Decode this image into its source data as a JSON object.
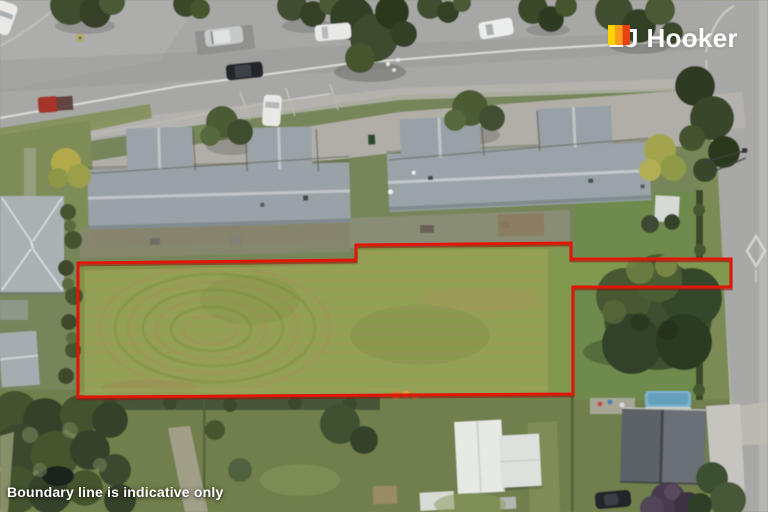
{
  "branding": {
    "agency_name": "LJ Hooker",
    "logo_mark": "lj-hooker-stripes-icon",
    "stripe_colors": [
      "#ffd203",
      "#ff9d1b",
      "#e8430e"
    ],
    "text_color": "#ffffff"
  },
  "disclaimer": {
    "text": "Boundary line is indicative only",
    "color": "#ffffff"
  },
  "boundary": {
    "color": "#e11508",
    "shadow_color": "#8d120b",
    "points": "78,263 356,260 356,245 571,243 571,259 731,259 731,287 573,287 573,394 78,397"
  },
  "scene": {
    "palette": {
      "road": "#a7a7a5",
      "property_lawn": "#92a054",
      "neighbour_grass": "#74854f",
      "unit_roof": "#9aa3a7",
      "white_roof": "#e7e9e5",
      "dark_shed": "#5d6266",
      "pool_water": "#7fb2cc",
      "tree_canopy": "#3d4c2c"
    }
  }
}
